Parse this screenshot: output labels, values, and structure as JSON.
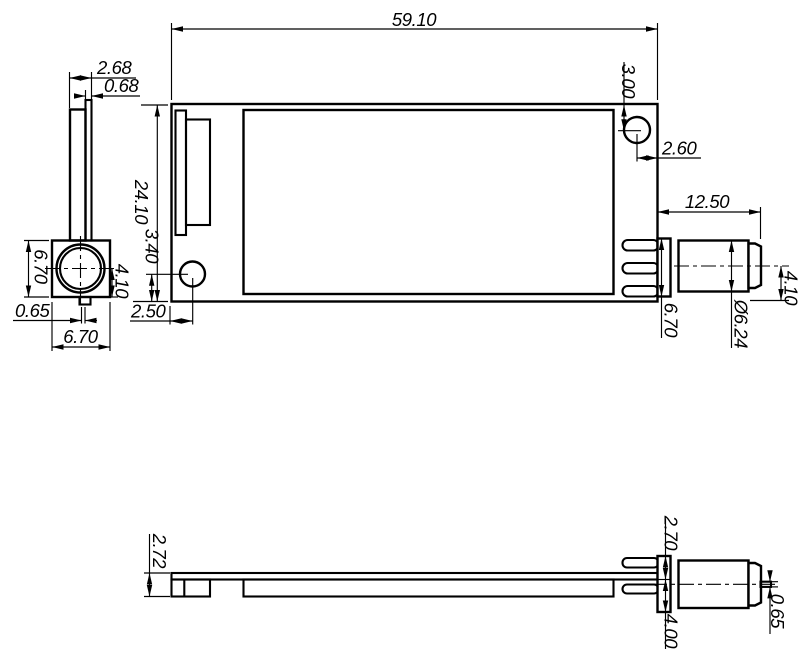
{
  "drawing": {
    "views": {
      "front": {
        "dims": {
          "width": "59.10",
          "height": "24.10",
          "hole_top": "3.00",
          "hole_right": "2.60",
          "hole_bottom": "3.40",
          "hole_left": "2.50",
          "sma_length": "12.50",
          "sma_axis_offset": "4.10",
          "sma_flange": "6.70",
          "sma_thread": "Ø6.24"
        }
      },
      "left": {
        "dims": {
          "stack": "2.68",
          "board": "0.68",
          "conn_height": "6.70",
          "conn_width": "6.70",
          "pin": "0.65",
          "axis_to_bottom": "4.10"
        }
      },
      "bottom": {
        "dims": {
          "total_thickness": "2.72",
          "above": "2.70",
          "below": "4.00",
          "pin": "0.65"
        }
      }
    },
    "line_color": "#000000",
    "background_color": "#ffffff"
  }
}
